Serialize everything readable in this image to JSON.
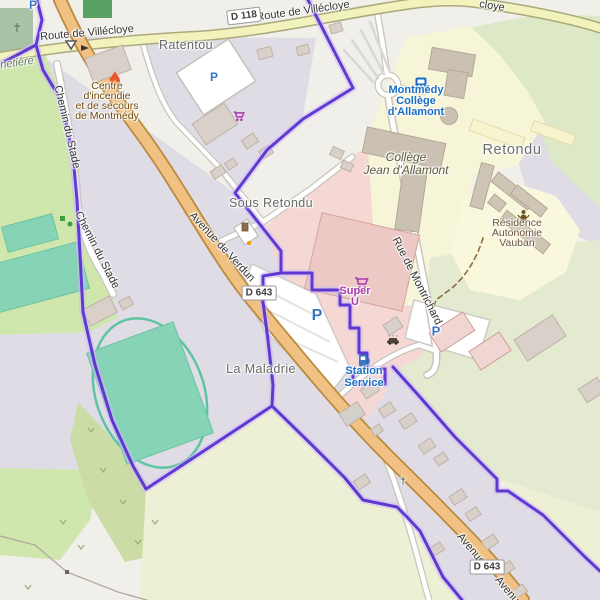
{
  "app": {
    "description": "OpenStreetMap-style web map of Montmédy area"
  },
  "colors": {
    "boundary_purple": "#5a31d0",
    "road_primary": "#f0c182",
    "road_primary_casing": "#b98a3e",
    "road_secondary": "#f2f2bc",
    "road_secondary_casing": "#a9a97b",
    "road_minor_casing": "#c9c5bd",
    "residential_area": "#dfdce6",
    "retail_area": "#f5d8d4",
    "education_area": "#f7f5d8",
    "farmland": "#eef0d6",
    "grass": "#cfe6ad",
    "pale_green": "#e4ead0",
    "scrub": "#cbdca7",
    "cemetery": "#a8c3a8",
    "pitch": "#86d3b5",
    "building": "#d9d0c9",
    "parking_blue": "#3875c2",
    "transit_blue": "#1a6fc4",
    "shop_purple": "#ac39ac",
    "amenity_brown": "#734a08"
  },
  "shields": {
    "d118": "D 118",
    "d643": "D 643"
  },
  "roads": {
    "villecloye": "Route de Villécloye",
    "villecloye_fragment": "cloye",
    "chemin_du_stade": "Chemin du Stade",
    "avenue_de_verdun": "Avenue de Verdun",
    "rue_de_montrichard": "Rue de Montrichard",
    "avenue": "Avenue",
    "avenue_fragment": "Avenu"
  },
  "places": {
    "ratentou": "Ratentou",
    "sous_retondu": "Sous Retondu",
    "retondu": "Retondu",
    "la_maladrie": "La Maladrie",
    "cimetiere_fragment": "netière"
  },
  "pois": {
    "fire_station": {
      "icon": "fire-flame-icon",
      "lines": [
        "Centre",
        "d'incendie",
        "et de secours",
        "de Montmédy"
      ]
    },
    "college": {
      "lines": [
        "Collège",
        "Jean d'Allamont"
      ]
    },
    "bus_stop": {
      "icon": "bus-icon",
      "lines": [
        "Montmédy",
        "Collège",
        "d'Allamont"
      ]
    },
    "residence": {
      "icon": "social-facility-icon",
      "lines": [
        "Résidence",
        "Autonomie",
        "Vauban"
      ]
    },
    "supermarket": {
      "icon": "shopping-cart-icon",
      "lines": [
        "Super",
        "U"
      ]
    },
    "fuel": {
      "icon": "fuel-pump-icon",
      "lines": [
        "Station",
        "Service"
      ]
    },
    "parking_letter": "P",
    "wayside_cross": "†"
  }
}
